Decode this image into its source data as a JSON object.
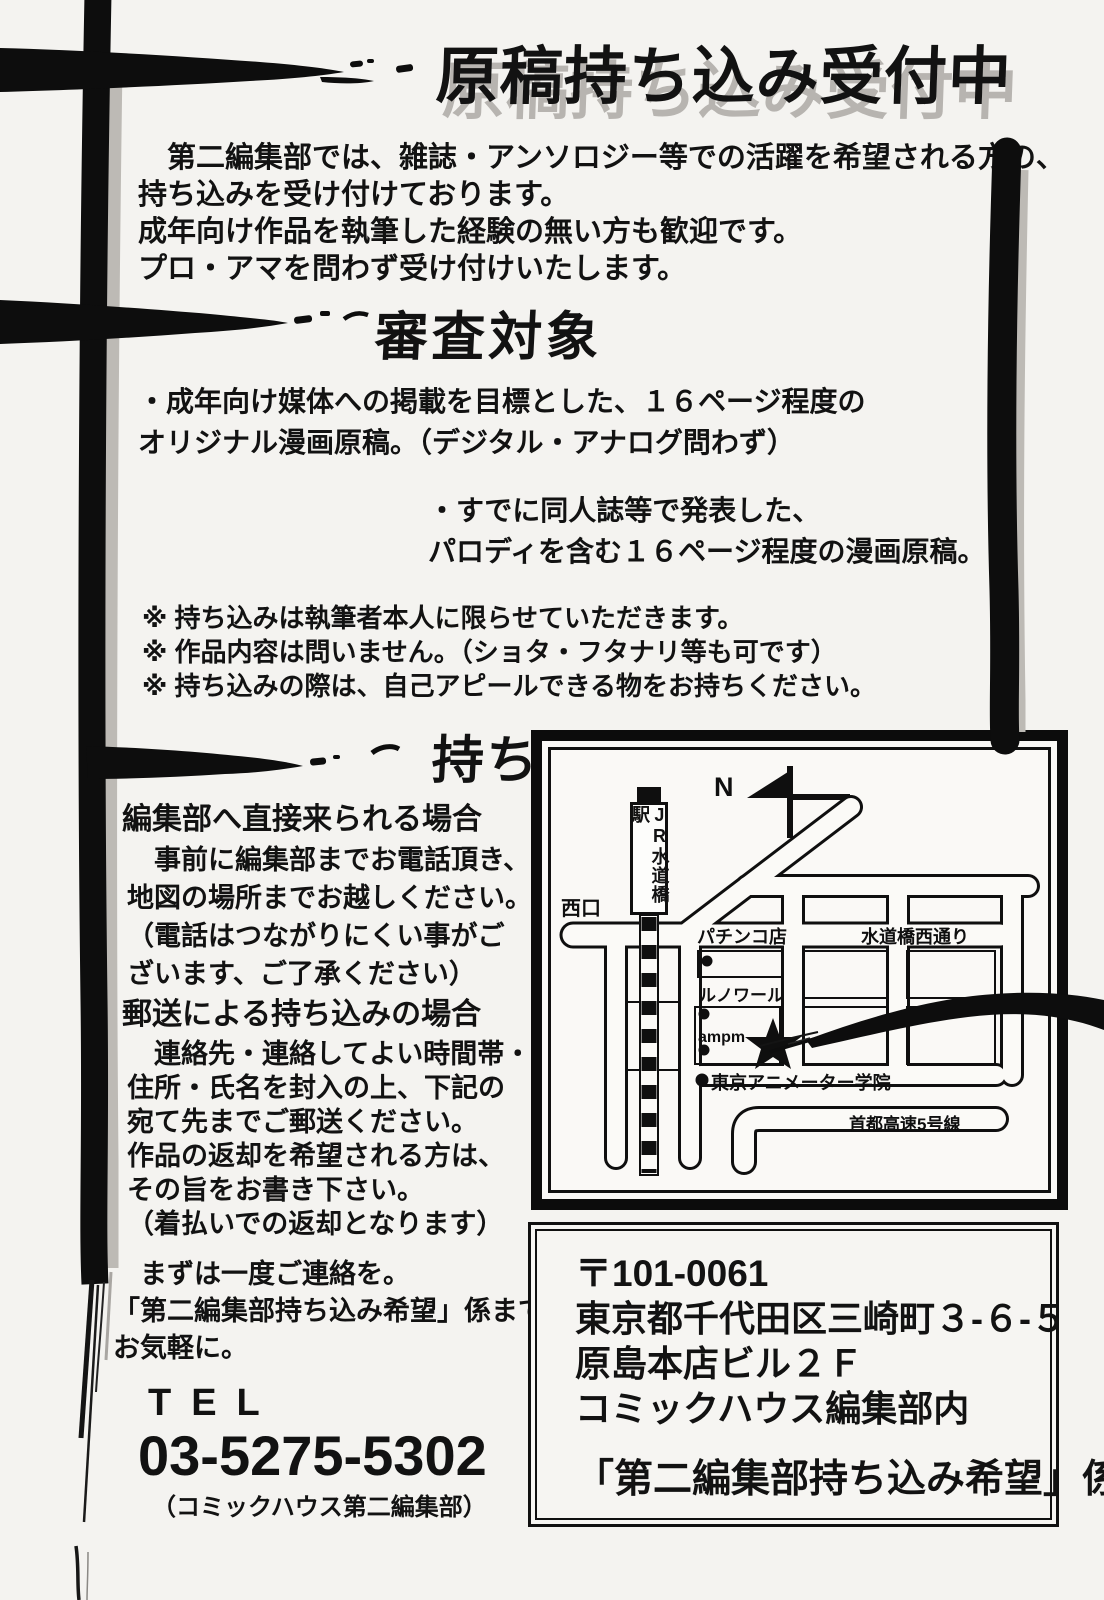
{
  "page": {
    "title": "原稿持ち込み受付中",
    "intro": {
      "lines": [
        "　第二編集部では、雑誌・アンソロジー等での活躍を希望される方の、",
        "持ち込みを受け付けております。",
        "成年向け作品を執筆した経験の無い方も歓迎です。",
        "プロ・アマを問わず受け付けいたします。"
      ]
    },
    "shinsa": {
      "heading": "審査対象",
      "bullet1_lines": [
        "・成年向け媒体への掲載を目標とした、１６ページ程度の",
        "オリジナル漫画原稿。（デジタル・アナログ問わず）"
      ],
      "bullet2_lines": [
        "・すでに同人誌等で発表した、",
        "パロディを含む１６ページ程度の漫画原稿。"
      ],
      "notes": [
        "※ 持ち込みは執筆者本人に限らせていただきます。",
        "※ 作品内容は問いません。（ショタ・フタナリ等も可です）",
        "※ 持ち込みの際は、自己アピールできる物をお持ちください。"
      ]
    },
    "houhou": {
      "heading": "持ち込み方法",
      "direct": {
        "heading": "編集部へ直接来られる場合",
        "lines": [
          "　事前に編集部までお電話頂き、",
          "地図の場所までお越しください。",
          "（電話はつながりにくい事がご",
          "ざいます、ご了承ください）"
        ]
      },
      "mail": {
        "heading": "郵送による持ち込みの場合",
        "lines": [
          "　連絡先・連絡してよい時間帯・",
          "住所・氏名を封入の上、下記の",
          "宛て先までご郵送ください。",
          "作品の返却を希望される方は、",
          "その旨をお書き下さい。",
          "（着払いでの返却となります）"
        ]
      },
      "contact_lines": [
        "　まずは一度ご連絡を。",
        "「第二編集部持ち込み希望」係まで",
        "お気軽に。"
      ],
      "tel_label": "TEL",
      "tel_number": "03-5275-5302",
      "tel_note": "（コミックハウス第二編集部）"
    },
    "map": {
      "compass_label": "N",
      "station": "JR水道橋駅",
      "west_exit": "西口",
      "pachinko": "パチンコ店",
      "street_west": "水道橋西通り",
      "renoir": "ルノワール",
      "ampm": "ampm",
      "animator_school": "東京アニメーター学院",
      "expressway": "首都高速5号線"
    },
    "address": {
      "postal": "〒101-0061",
      "line1": "東京都千代田区三崎町３-６-５",
      "line2": "原島本店ビル２Ｆ",
      "line3": "コミックハウス編集部内",
      "attention": "「第二編集部持ち込み希望」係"
    },
    "colors": {
      "ink": "#121212",
      "shadow_gray": "#bdbab5",
      "paper": "#f4f3f0"
    }
  }
}
